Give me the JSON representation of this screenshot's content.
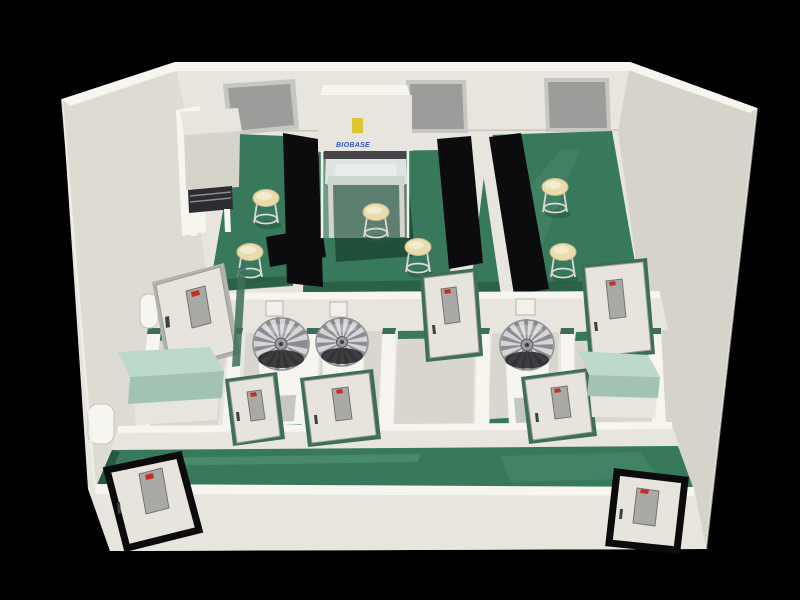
{
  "branding": {
    "cabinet_label": "BIOBASE"
  },
  "colors": {
    "background": "#000000",
    "wall": "#e8e5de",
    "wall_bright": "#f6f5f0",
    "wall_shadow": "#d6d3cb",
    "wall_shadow2": "#dedbd3",
    "floor_green": "#37795a",
    "floor_green_dark": "#27593f",
    "floor_green_light": "#5a9b78",
    "floor_light_gray": "#d9d6cf",
    "bench_black": "#0c0c0e",
    "bench_mint": "#bcd9c9",
    "bench_mint_front": "#a2c3b2",
    "table_dark_green": "#1f4e3a",
    "stool_cushion": "#e9dcab",
    "stool_leg": "#d8d8d8",
    "window_gray": "#9c9c9a",
    "window_frame": "#c6c6c2",
    "door_leaf": "#e7e4dd",
    "door_glass": "#a9a9a5",
    "door_frame_green": "#3d6f58",
    "front_door_frame": "#0b0b0b",
    "fan_silver": "#d4d5d7",
    "fan_dark": "#232327",
    "label_yellow": "#d9c832",
    "logo_blue": "#2a55c8",
    "sign_red": "#c03028",
    "equipment_dark": "#2d2d30",
    "panel_gray": "#c6c6c2"
  },
  "scene": {
    "description": "Cutaway 3D rendering of a laboratory suite with green epoxy floors, cream walls, black lab benches and glass-panel doors on a black background",
    "counts": {
      "back_wall_windows": 3,
      "lab_stools": 6,
      "radial_fan_units": 3,
      "interior_doors": 6,
      "entry_doors": 2,
      "black_benches": 4,
      "mint_benches": 2,
      "wall_pass_boxes": 3
    },
    "equipment": [
      "biosafety-cabinet",
      "workstation-desk",
      "radial-fan-units",
      "island-table"
    ]
  }
}
